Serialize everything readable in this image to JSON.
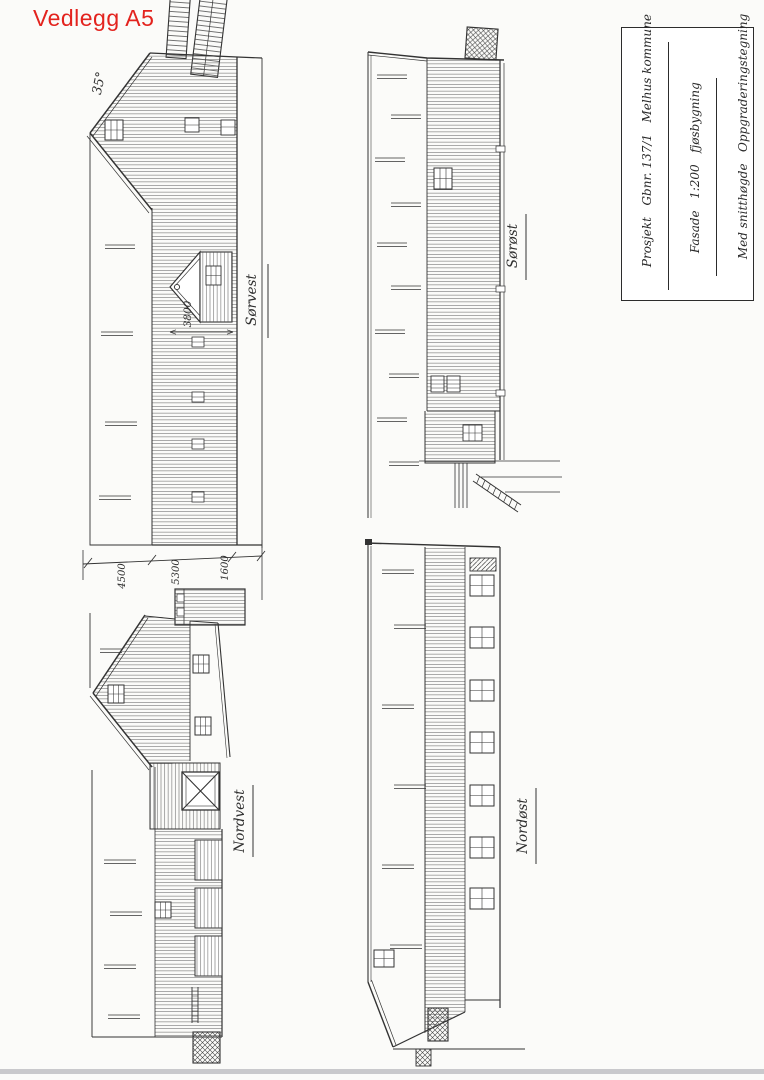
{
  "page": {
    "header_label": "Vedlegg A5",
    "paper_color": "#fbfbf9",
    "ink_color": "#333333",
    "header_color": "#e3231e",
    "scan_edge_color": "#c9c9cc"
  },
  "title_block": {
    "line1": "Prosjekt   Gbnr. 137/1   Melhus kommune",
    "line2": "Fasade   1:200   fjøsbygning",
    "line3": "Med snitthøgde   Oppgraderingstegning",
    "date": "17/2-26"
  },
  "elevations": [
    {
      "id": "sorvest",
      "label": "Sørvest",
      "roof_angle": "35°",
      "cupola_dimension": "3800",
      "bottom_dimensions": [
        "4500",
        "5300",
        "1600"
      ]
    },
    {
      "id": "sorost",
      "label": "Sørøst"
    },
    {
      "id": "nordvest",
      "label": "Nordvest"
    },
    {
      "id": "nordost",
      "label": "Nordøst"
    }
  ]
}
